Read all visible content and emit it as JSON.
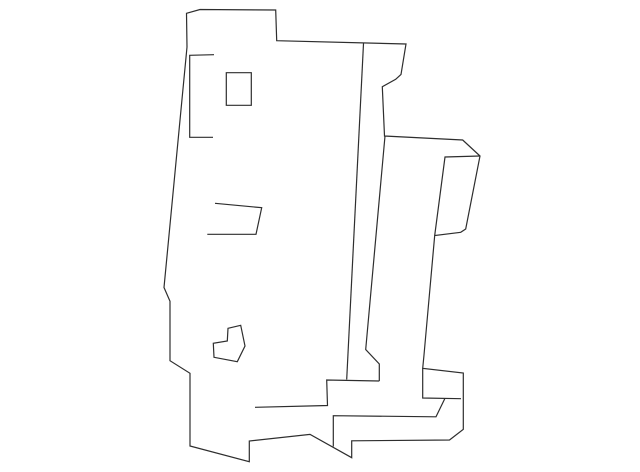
{
  "canvas": {
    "width": 640,
    "height": 472,
    "background": "#ffffff"
  },
  "drawing": {
    "kind": "monochrome line-art part diagram (sheet-metal bracket/panel, side view)",
    "stroke_color": "#2e2e2e",
    "stroke_width": 1.2,
    "paths": [
      {
        "name": "main-outline",
        "closed": true,
        "points": [
          [
            186.5,
            13.3
          ],
          [
            200,
            9.5
          ],
          [
            275.7,
            10
          ],
          [
            276.7,
            40.7
          ],
          [
            406,
            44
          ],
          [
            401,
            74.5
          ],
          [
            395.7,
            79.3
          ],
          [
            382.3,
            86.7
          ],
          [
            384.5,
            136
          ],
          [
            462.7,
            140
          ],
          [
            480,
            156
          ],
          [
            465.7,
            229
          ],
          [
            460.7,
            232.3
          ],
          [
            434.7,
            235.5
          ],
          [
            424,
            355
          ],
          [
            422.7,
            368.3
          ],
          [
            463.3,
            373
          ],
          [
            463.3,
            429.3
          ],
          [
            449.5,
            440
          ],
          [
            351.7,
            440.8
          ],
          [
            351.7,
            457.7
          ],
          [
            310,
            434.4
          ],
          [
            249.3,
            441
          ],
          [
            249.3,
            461.7
          ],
          [
            190,
            446
          ],
          [
            190,
            373.3
          ],
          [
            170,
            360.7
          ],
          [
            170,
            301.3
          ],
          [
            164,
            287.5
          ],
          [
            187,
            47
          ]
        ]
      },
      {
        "name": "flange-bracket-line",
        "closed": false,
        "points": [
          [
            214,
            54.7
          ],
          [
            189.7,
            55.3
          ],
          [
            189.7,
            137.3
          ],
          [
            213,
            137.3
          ]
        ]
      },
      {
        "name": "rectangular-hole",
        "closed": true,
        "points": [
          [
            226.3,
            72.7
          ],
          [
            251.3,
            72.7
          ],
          [
            251.3,
            105.3
          ],
          [
            226.3,
            105.3
          ]
        ]
      },
      {
        "name": "slot-outline",
        "closed": false,
        "points": [
          [
            215,
            203.3
          ],
          [
            261.7,
            207.7
          ],
          [
            256,
            234.3
          ],
          [
            207.3,
            234.3
          ]
        ]
      },
      {
        "name": "l-shaped-hole",
        "closed": true,
        "points": [
          [
            228,
            328.3
          ],
          [
            240.7,
            325.3
          ],
          [
            245,
            346
          ],
          [
            237.3,
            361.7
          ],
          [
            214,
            357.3
          ],
          [
            213.3,
            343.3
          ],
          [
            227.3,
            341
          ]
        ]
      },
      {
        "name": "fold-line-left",
        "closed": false,
        "points": [
          [
            363.5,
            43.5
          ],
          [
            346.7,
            379.5
          ]
        ]
      },
      {
        "name": "fold-line-right",
        "closed": false,
        "points": [
          [
            385,
            136
          ],
          [
            365.7,
            349.5
          ],
          [
            379.3,
            364
          ],
          [
            379.3,
            381
          ]
        ]
      },
      {
        "name": "shelf-edge",
        "closed": false,
        "points": [
          [
            379.3,
            381
          ],
          [
            326.7,
            380
          ],
          [
            327.5,
            405.5
          ],
          [
            255,
            407.3
          ]
        ]
      },
      {
        "name": "flag-inner-edge",
        "closed": false,
        "points": [
          [
            480,
            156
          ],
          [
            445,
            157
          ],
          [
            434.7,
            235.5
          ]
        ]
      },
      {
        "name": "block-inner-edge",
        "closed": false,
        "points": [
          [
            422.7,
            368.3
          ],
          [
            422.7,
            398
          ],
          [
            461,
            398.7
          ]
        ]
      },
      {
        "name": "base-inner-edge",
        "closed": false,
        "points": [
          [
            333.3,
            446.5
          ],
          [
            333.3,
            415.7
          ],
          [
            436,
            416.8
          ],
          [
            445,
            398.3
          ]
        ]
      }
    ]
  }
}
